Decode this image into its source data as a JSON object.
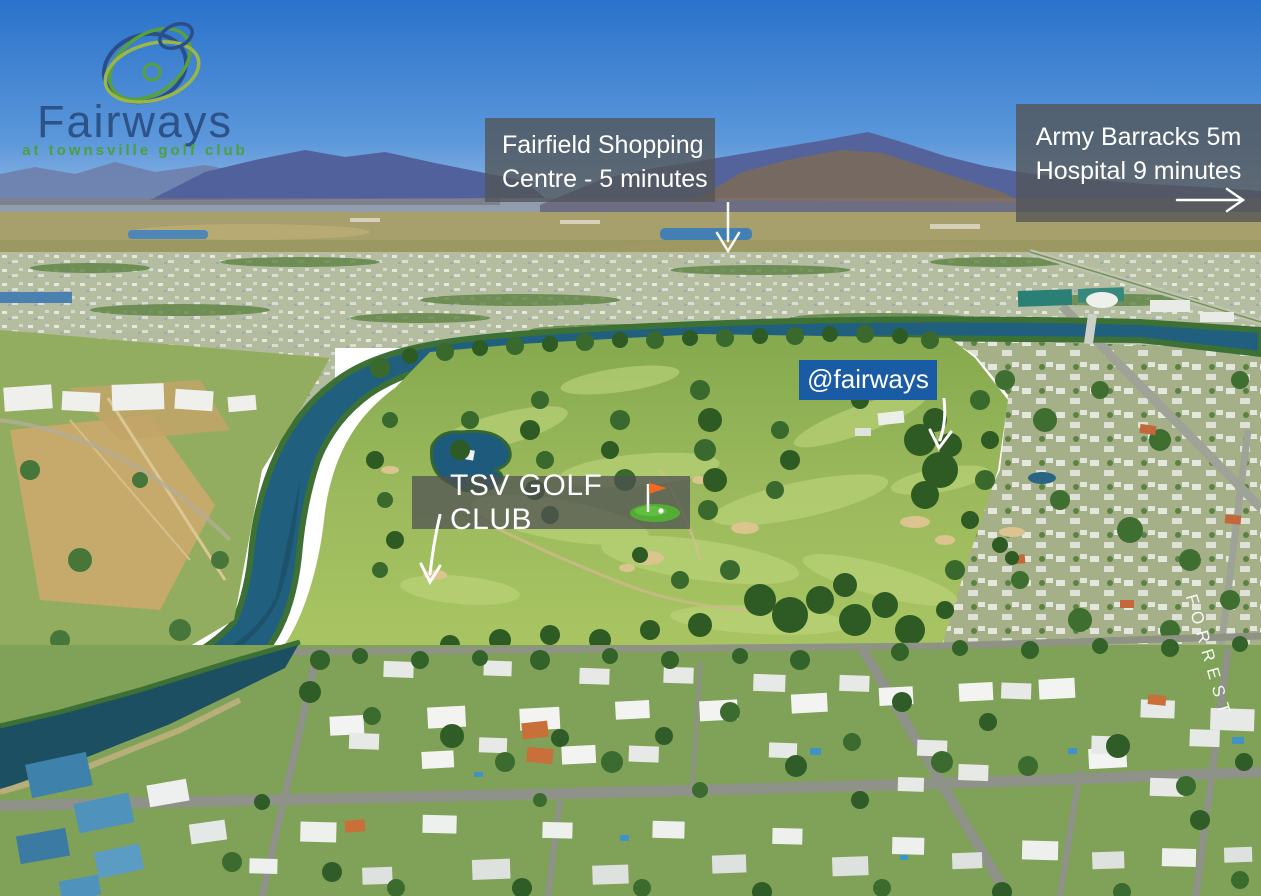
{
  "logo": {
    "title": "Fairways",
    "subtitle": "at townsville golf club"
  },
  "annotations": {
    "fairfield": {
      "line1": "Fairfield Shopping",
      "line2": "Centre - 5 minutes"
    },
    "army": {
      "line1": "Army Barracks 5m",
      "line2": "Hospital 9 minutes"
    },
    "social": {
      "text": "@fairways"
    },
    "golf_club": {
      "text": "TSV GOLF CLUB"
    },
    "street": {
      "text": "FORREST"
    }
  },
  "icons": {
    "logo_mark": "fairways-logo-icon",
    "fairfield_arrow": "down-arrow-icon",
    "army_arrow": "right-arrow-icon",
    "social_arrow": "down-arrow-icon",
    "golf_club_arrow": "down-arrow-icon",
    "golf_flag": "golf-flag-icon"
  },
  "colors": {
    "social_box_bg": "#1a5ba6",
    "overlay_box_bg": "rgba(82,84,86,0.78)",
    "logo_title": "#2d5287",
    "logo_subtitle": "#4f9e3d",
    "flag_orange": "#f26a22",
    "arrow": "#ffffff",
    "river": "#20607e",
    "golf_grass": "#a3c062"
  }
}
